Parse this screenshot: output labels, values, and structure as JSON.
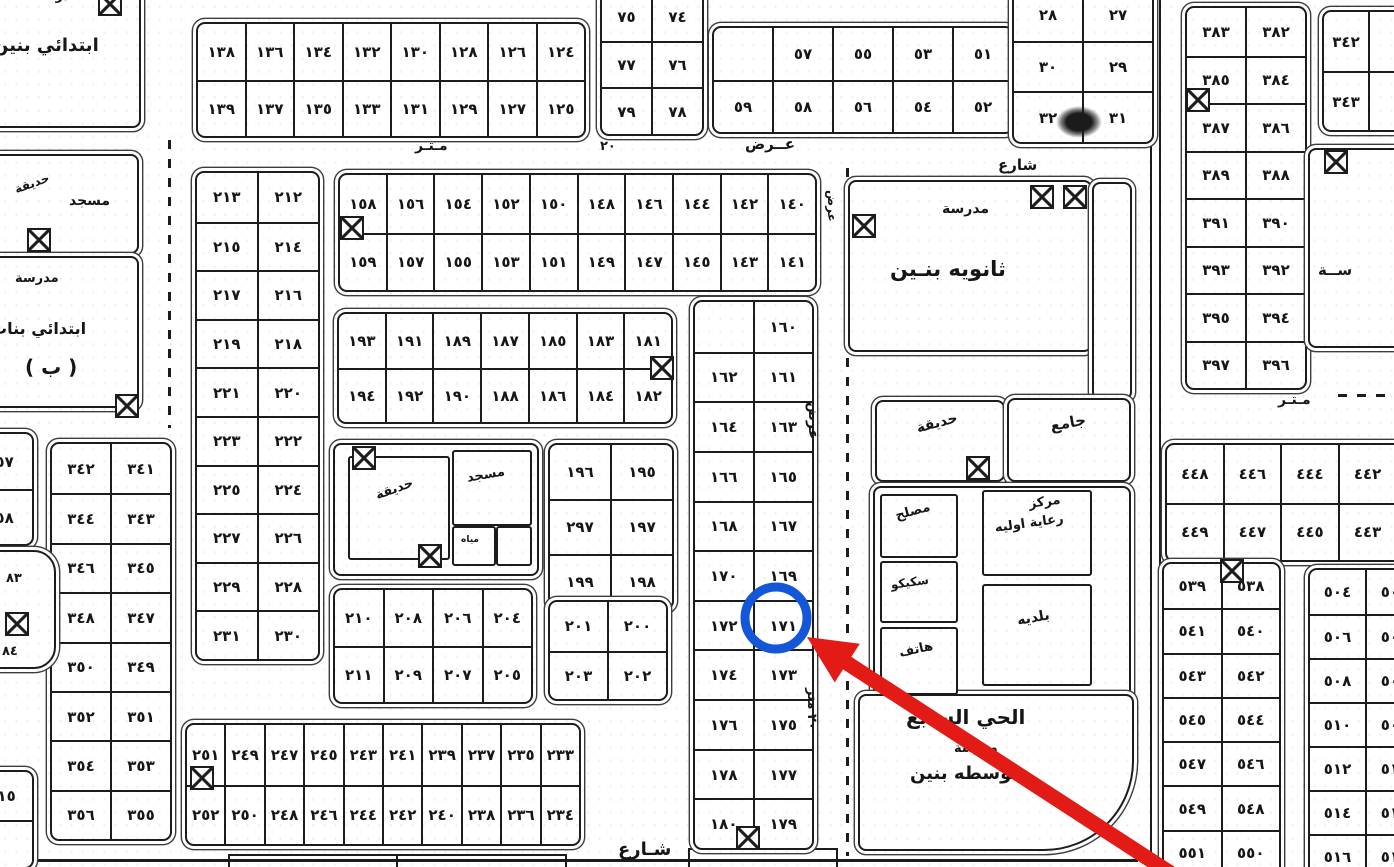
{
  "annotation": {
    "target_plot": "١٧١",
    "circle": {
      "cx": 776,
      "cy": 618,
      "r": 31,
      "stroke": "#1456d8",
      "width": 9
    },
    "arrow": {
      "color": "#e31b17",
      "tip_x": 807,
      "tip_y": 637,
      "tail_x": 1172,
      "tail_y": 874,
      "head_len": 48,
      "head_halfw": 23,
      "shaft_w": 15
    }
  },
  "street_labels": [
    {
      "t": "مـتـر",
      "x": 415,
      "y": 139,
      "s": 14,
      "r": 0
    },
    {
      "t": "٢٠",
      "x": 600,
      "y": 140,
      "s": 13,
      "r": 0
    },
    {
      "t": "عــرض",
      "x": 745,
      "y": 136,
      "s": 15,
      "r": 0
    },
    {
      "t": "شارع",
      "x": 998,
      "y": 157,
      "s": 15,
      "r": 0
    },
    {
      "t": "مـتـر",
      "x": 1278,
      "y": 393,
      "s": 14,
      "r": 0
    },
    {
      "t": "عرض",
      "x": 820,
      "y": 402,
      "s": 14,
      "r": 90
    },
    {
      "t": "٢٠ متر",
      "x": 818,
      "y": 688,
      "s": 13,
      "r": 90
    },
    {
      "t": "عرض",
      "x": 838,
      "y": 190,
      "s": 12,
      "r": 90
    },
    {
      "t": "شـارع",
      "x": 618,
      "y": 840,
      "s": 18,
      "r": 0
    },
    {
      "t": "٨٣",
      "x": 6,
      "y": 572,
      "s": 13,
      "r": 0
    },
    {
      "t": "٨٤",
      "x": 2,
      "y": 645,
      "s": 13,
      "r": 0
    }
  ],
  "plot_blocks": [
    {
      "name": "block-124-139",
      "x": 196,
      "y": 22,
      "w": 386,
      "h": 112,
      "rows": [
        [
          "١٣٨",
          "١٣٦",
          "١٣٤",
          "١٣٢",
          "١٣٠",
          "١٢٨",
          "١٢٦",
          "١٢٤"
        ],
        [
          "١٣٩",
          "١٣٧",
          "١٣٥",
          "١٣٣",
          "١٣١",
          "١٢٩",
          "١٢٧",
          "١٢٥"
        ]
      ]
    },
    {
      "name": "block-74-79",
      "x": 600,
      "y": -8,
      "w": 100,
      "h": 140,
      "rows": [
        [
          "٧٥",
          "٧٤"
        ],
        [
          "٧٧",
          "٧٦"
        ],
        [
          "٧٩",
          "٧٨"
        ]
      ]
    },
    {
      "name": "block-51-59",
      "x": 712,
      "y": 26,
      "w": 298,
      "h": 104,
      "rows": [
        [
          null,
          "٥٧",
          "٥٥",
          "٥٣",
          "٥١"
        ],
        [
          "٥٩",
          "٥٨",
          "٥٦",
          "٥٤",
          "٥٢"
        ]
      ]
    },
    {
      "name": "block-27-32",
      "x": 1012,
      "y": -12,
      "w": 138,
      "h": 152,
      "rows": [
        [
          "٢٨",
          "٢٧"
        ],
        [
          "٣٠",
          "٢٩"
        ],
        [
          "٣٢",
          "٣١"
        ]
      ]
    },
    {
      "name": "block-382-397",
      "x": 1185,
      "y": 6,
      "w": 118,
      "h": 380,
      "rows": [
        [
          "٣٨٣",
          "٣٨٢"
        ],
        [
          "٣٨٥",
          "٣٨٤"
        ],
        [
          "٣٨٧",
          "٣٨٦"
        ],
        [
          "٣٨٩",
          "٣٨٨"
        ],
        [
          "٣٩١",
          "٣٩٠"
        ],
        [
          "٣٩٣",
          "٣٩٢"
        ],
        [
          "٣٩٥",
          "٣٩٤"
        ],
        [
          "٣٩٧",
          "٣٩٦"
        ]
      ]
    },
    {
      "name": "block-342-343",
      "x": 1322,
      "y": 10,
      "w": 90,
      "h": 118,
      "rows": [
        [
          "٣٤٢",
          ""
        ],
        [
          "٣٤٣",
          ""
        ]
      ]
    },
    {
      "name": "block-440-449",
      "x": 1165,
      "y": 443,
      "w": 286,
      "h": 115,
      "rows": [
        [
          "٤٤٨",
          "٤٤٦",
          "٤٤٤",
          "٤٤٢",
          "٤٤٠"
        ],
        [
          "٤٤٩",
          "٤٤٧",
          "٤٤٥",
          "٤٤٣",
          "٤٤١"
        ]
      ]
    },
    {
      "name": "block-538-551",
      "x": 1162,
      "y": 562,
      "w": 115,
      "h": 310,
      "rows": [
        [
          "٥٣٩",
          "٥٣٨"
        ],
        [
          "٥٤١",
          "٥٤٠"
        ],
        [
          "٥٤٣",
          "٥٤٢"
        ],
        [
          "٥٤٥",
          "٥٤٤"
        ],
        [
          "٥٤٧",
          "٥٤٦"
        ],
        [
          "٥٤٩",
          "٥٤٨"
        ],
        [
          "٥٥١",
          "٥٥٠"
        ]
      ]
    },
    {
      "name": "block-503-516",
      "x": 1308,
      "y": 568,
      "w": 112,
      "h": 308,
      "rows": [
        [
          "٥٠٤",
          "٥٠٣"
        ],
        [
          "٥٠٦",
          "٥٠٥"
        ],
        [
          "٥٠٨",
          "٥٠٧"
        ],
        [
          "٥١٠",
          "٥٠٩"
        ],
        [
          "٥١٢",
          "٥١١"
        ],
        [
          "٥١٤",
          "٥١٣"
        ],
        [
          "٥١٦",
          "٥١٥"
        ]
      ]
    },
    {
      "name": "block-341-356",
      "x": 50,
      "y": 442,
      "w": 118,
      "h": 395,
      "rows": [
        [
          "٣٤٢",
          "٣٤١"
        ],
        [
          "٣٤٤",
          "٣٤٣"
        ],
        [
          "٣٤٦",
          "٣٤٥"
        ],
        [
          "٣٤٨",
          "٣٤٧"
        ],
        [
          "٣٥٠",
          "٣٤٩"
        ],
        [
          "٣٥٢",
          "٣٥١"
        ],
        [
          "٣٥٤",
          "٣٥٣"
        ],
        [
          "٣٥٦",
          "٣٥٥"
        ]
      ]
    },
    {
      "name": "block-212-231",
      "x": 195,
      "y": 171,
      "w": 121,
      "h": 486,
      "rows": [
        [
          "٢١٣",
          "٢١٢"
        ],
        [
          "٢١٥",
          "٢١٤"
        ],
        [
          "٢١٧",
          "٢١٦"
        ],
        [
          "٢١٩",
          "٢١٨"
        ],
        [
          "٢٢١",
          "٢٢٠"
        ],
        [
          "٢٢٣",
          "٢٢٢"
        ],
        [
          "٢٢٥",
          "٢٢٤"
        ],
        [
          "٢٢٧",
          "٢٢٦"
        ],
        [
          "٢٢٩",
          "٢٢٨"
        ],
        [
          "٢٣١",
          "٢٣٠"
        ]
      ]
    },
    {
      "name": "block-140-159",
      "x": 338,
      "y": 173,
      "w": 475,
      "h": 115,
      "rows": [
        [
          "١٥٨",
          "١٥٦",
          "١٥٤",
          "١٥٢",
          "١٥٠",
          "١٤٨",
          "١٤٦",
          "١٤٤",
          "١٤٢",
          "١٤٠"
        ],
        [
          "١٥٩",
          "١٥٧",
          "١٥٥",
          "١٥٣",
          "١٥١",
          "١٤٩",
          "١٤٧",
          "١٤٥",
          "١٤٣",
          "١٤١"
        ]
      ]
    },
    {
      "name": "block-181-194",
      "x": 337,
      "y": 312,
      "w": 332,
      "h": 108,
      "rows": [
        [
          "١٩٣",
          "١٩١",
          "١٨٩",
          "١٨٧",
          "١٨٥",
          "١٨٣",
          "١٨١"
        ],
        [
          "١٩٤",
          "١٩٢",
          "١٩٠",
          "١٨٨",
          "١٨٦",
          "١٨٤",
          "١٨٢"
        ]
      ]
    },
    {
      "name": "block-195-199",
      "x": 548,
      "y": 443,
      "w": 122,
      "h": 163,
      "rows": [
        [
          "١٩٦",
          "١٩٥"
        ],
        [
          "٢٩٧",
          "١٩٧"
        ],
        [
          "١٩٩",
          "١٩٨"
        ]
      ]
    },
    {
      "name": "block-200-203",
      "x": 548,
      "y": 600,
      "w": 116,
      "h": 97,
      "rows": [
        [
          "٢٠١",
          "٢٠٠"
        ],
        [
          "٢٠٣",
          "٢٠٢"
        ]
      ]
    },
    {
      "name": "block-204-211",
      "x": 333,
      "y": 588,
      "w": 196,
      "h": 112,
      "rows": [
        [
          "٢١٠",
          "٢٠٨",
          "٢٠٦",
          "٢٠٤"
        ],
        [
          "٢١١",
          "٢٠٩",
          "٢٠٧",
          "٢٠٥"
        ]
      ]
    },
    {
      "name": "block-160-180",
      "x": 693,
      "y": 300,
      "w": 117,
      "h": 546,
      "rows": [
        [
          null,
          "١٦٠"
        ],
        [
          "١٦٢",
          "١٦١"
        ],
        [
          "١٦٤",
          "١٦٣"
        ],
        [
          "١٦٦",
          "١٦٥"
        ],
        [
          "١٦٨",
          "١٦٧"
        ],
        [
          "١٧٠",
          "١٦٩"
        ],
        [
          "١٧٢",
          "١٧١"
        ],
        [
          "١٧٤",
          "١٧٣"
        ],
        [
          "١٧٦",
          "١٧٥"
        ],
        [
          "١٧٨",
          "١٧٧"
        ],
        [
          "١٨٠",
          "١٧٩"
        ]
      ]
    },
    {
      "name": "block-233-252",
      "x": 185,
      "y": 723,
      "w": 392,
      "h": 119,
      "rows": [
        [
          "٢٥١",
          "٢٤٩",
          "٢٤٧",
          "٢٤٥",
          "٢٤٣",
          "٢٤١",
          "٢٣٩",
          "٢٣٧",
          "٢٣٥",
          "٢٣٣"
        ],
        [
          "٢٥٢",
          "٢٥٠",
          "٢٤٨",
          "٢٤٦",
          "٢٤٤",
          "٢٤٢",
          "٢٤٠",
          "٢٣٨",
          "٢٣٦",
          "٢٣٤"
        ]
      ]
    },
    {
      "name": "block-357-358",
      "x": -34,
      "y": 432,
      "w": 64,
      "h": 110,
      "rows": [
        [
          "٣٥٧"
        ],
        [
          "٣٥٨"
        ]
      ]
    },
    {
      "name": "block-515",
      "x": -30,
      "y": 770,
      "w": 60,
      "h": 95,
      "rows": [
        [
          "٥١٥"
        ],
        [
          ""
        ]
      ]
    }
  ],
  "buildings": [
    {
      "name": "school-boys-primary",
      "x": -15,
      "y": -10,
      "w": 152,
      "h": 134,
      "labels": [
        {
          "t": "مدرسة",
          "x": 48,
          "y": -2,
          "s": 13,
          "r": 0
        },
        {
          "t": "ابتدائي بنين",
          "x": 6,
          "y": 44,
          "s": 18,
          "r": 0
        }
      ]
    },
    {
      "name": "mosque-garden-west",
      "x": -15,
      "y": 154,
      "w": 150,
      "h": 96,
      "labels": [
        {
          "t": "حديقة",
          "x": 26,
          "y": 28,
          "s": 12,
          "r": -20
        },
        {
          "t": "مسجد",
          "x": 82,
          "y": 38,
          "s": 14,
          "r": 0
        }
      ]
    },
    {
      "name": "school-girls-primary",
      "x": -15,
      "y": 256,
      "w": 150,
      "h": 148,
      "labels": [
        {
          "t": "مدرسة",
          "x": 28,
          "y": 14,
          "s": 13,
          "r": 0
        },
        {
          "t": "ابتدائي بنات",
          "x": 4,
          "y": 62,
          "s": 16,
          "r": 0
        },
        {
          "t": "( ب )",
          "x": 38,
          "y": 98,
          "s": 20,
          "r": 0
        }
      ]
    },
    {
      "name": "school-secondary-boys",
      "x": 848,
      "y": 180,
      "w": 240,
      "h": 168,
      "labels": [
        {
          "t": "مدرسة",
          "x": 92,
          "y": 20,
          "s": 14,
          "r": 0
        },
        {
          "t": "ثانويه بنـين",
          "x": 40,
          "y": 76,
          "s": 21,
          "r": 0
        }
      ]
    },
    {
      "name": "school-corridor",
      "x": 1092,
      "y": 182,
      "w": 36,
      "h": 214,
      "labels": []
    },
    {
      "name": "right-edge-building",
      "x": 1308,
      "y": 148,
      "w": 100,
      "h": 196,
      "labels": [
        {
          "t": "ســة",
          "x": 8,
          "y": 112,
          "s": 15,
          "r": 0
        }
      ]
    },
    {
      "name": "garden-park",
      "x": 875,
      "y": 400,
      "w": 126,
      "h": 78,
      "labels": [
        {
          "t": "حديقة",
          "x": 38,
          "y": 20,
          "s": 14,
          "r": -15
        }
      ]
    },
    {
      "name": "jami-mosque",
      "x": 1007,
      "y": 398,
      "w": 120,
      "h": 80,
      "labels": [
        {
          "t": "جامع",
          "x": 40,
          "y": 18,
          "s": 15,
          "r": -10
        }
      ]
    },
    {
      "name": "services-compound",
      "x": 873,
      "y": 486,
      "w": 254,
      "h": 229,
      "labels": []
    },
    {
      "name": "maslah-office",
      "x": 880,
      "y": 494,
      "w": 74,
      "h": 60,
      "inner": true,
      "labels": [
        {
          "t": "مصلح",
          "x": 12,
          "y": 14,
          "s": 13,
          "r": -15
        }
      ]
    },
    {
      "name": "sceco-electric",
      "x": 880,
      "y": 561,
      "w": 74,
      "h": 58,
      "inner": true,
      "labels": [
        {
          "t": "سكيكو",
          "x": 8,
          "y": 16,
          "s": 12,
          "r": -8
        }
      ]
    },
    {
      "name": "telephone-office",
      "x": 880,
      "y": 627,
      "w": 74,
      "h": 64,
      "inner": true,
      "labels": [
        {
          "t": "هاتف",
          "x": 16,
          "y": 18,
          "s": 13,
          "r": -12
        }
      ]
    },
    {
      "name": "primary-care-center",
      "x": 982,
      "y": 490,
      "w": 106,
      "h": 82,
      "inner": true,
      "labels": [
        {
          "t": "مركز",
          "x": 44,
          "y": 6,
          "s": 13,
          "r": -8
        },
        {
          "t": "رعاية اوليه",
          "x": 10,
          "y": 30,
          "s": 13,
          "r": -8
        }
      ]
    },
    {
      "name": "municipality",
      "x": 982,
      "y": 584,
      "w": 106,
      "h": 98,
      "inner": true,
      "labels": [
        {
          "t": "بلديه",
          "x": 32,
          "y": 28,
          "s": 14,
          "r": -10
        }
      ]
    },
    {
      "name": "district-middle-school",
      "x": 858,
      "y": 694,
      "w": 272,
      "h": 153,
      "radius": "8px 8px 90px 8px",
      "labels": [
        {
          "t": "الحي السابع",
          "x": 46,
          "y": 10,
          "s": 20,
          "r": 0
        },
        {
          "t": "مدرسة",
          "x": 94,
          "y": 46,
          "s": 13,
          "r": 0
        },
        {
          "t": "متوسطه بنين",
          "x": 50,
          "y": 68,
          "s": 18,
          "r": 0
        }
      ]
    },
    {
      "name": "mosque-complex",
      "x": 333,
      "y": 443,
      "w": 202,
      "h": 129,
      "labels": []
    },
    {
      "name": "complex-garden",
      "x": 348,
      "y": 456,
      "w": 98,
      "h": 100,
      "inner": true,
      "labels": [
        {
          "t": "حديقة",
          "x": 24,
          "y": 32,
          "s": 13,
          "r": -20
        }
      ]
    },
    {
      "name": "complex-mosque",
      "x": 452,
      "y": 450,
      "w": 76,
      "h": 72,
      "inner": true,
      "labels": [
        {
          "t": "مسجد",
          "x": 12,
          "y": 20,
          "s": 13,
          "r": -10
        }
      ]
    },
    {
      "name": "complex-water-room",
      "x": 452,
      "y": 526,
      "w": 40,
      "h": 36,
      "inner": true,
      "labels": [
        {
          "t": "مياه",
          "x": 7,
          "y": 8,
          "s": 9,
          "r": 0
        }
      ]
    },
    {
      "name": "complex-small-room",
      "x": 496,
      "y": 526,
      "w": 32,
      "h": 36,
      "inner": true,
      "labels": []
    },
    {
      "name": "octagon-lot",
      "x": -28,
      "y": 550,
      "w": 80,
      "h": 115,
      "radius": "22px",
      "labels": []
    }
  ],
  "xbox_icons": [
    {
      "x": 98,
      "y": -8
    },
    {
      "x": 27,
      "y": 228
    },
    {
      "x": 115,
      "y": 394
    },
    {
      "x": 340,
      "y": 216
    },
    {
      "x": 650,
      "y": 356
    },
    {
      "x": 352,
      "y": 446
    },
    {
      "x": 418,
      "y": 544
    },
    {
      "x": 852,
      "y": 214
    },
    {
      "x": 1030,
      "y": 185
    },
    {
      "x": 1063,
      "y": 185
    },
    {
      "x": 966,
      "y": 456
    },
    {
      "x": 1186,
      "y": 88
    },
    {
      "x": 1324,
      "y": 150
    },
    {
      "x": 1220,
      "y": 559
    },
    {
      "x": 190,
      "y": 766
    },
    {
      "x": 736,
      "y": 826
    },
    {
      "x": 5,
      "y": 612
    }
  ],
  "lines": [
    {
      "x": 846,
      "y": 168,
      "len": 688,
      "o": "v",
      "dash": true
    },
    {
      "x": 168,
      "y": 140,
      "len": 288,
      "o": "v",
      "dash": true
    },
    {
      "x": 1338,
      "y": 394,
      "len": 58,
      "o": "h",
      "dash": true
    },
    {
      "x": 1150,
      "y": 0,
      "len": 862,
      "o": "v",
      "dash": false
    },
    {
      "x": 1159,
      "y": 0,
      "len": 862,
      "o": "v",
      "dash": false
    },
    {
      "x": 60,
      "y": 158,
      "len": 90,
      "o": "v",
      "dash": false
    },
    {
      "x": 0,
      "y": 859,
      "len": 1138,
      "o": "h",
      "dash": false,
      "w": 3
    },
    {
      "x": 228,
      "y": 854,
      "len": 338,
      "o": "h",
      "dash": false
    },
    {
      "x": 228,
      "y": 854,
      "len": 13,
      "o": "v",
      "dash": false
    },
    {
      "x": 396,
      "y": 854,
      "len": 13,
      "o": "v",
      "dash": false
    },
    {
      "x": 565,
      "y": 854,
      "len": 13,
      "o": "v",
      "dash": false
    },
    {
      "x": 688,
      "y": 848,
      "len": 150,
      "o": "h",
      "dash": false
    },
    {
      "x": 688,
      "y": 848,
      "len": 19,
      "o": "v",
      "dash": false
    },
    {
      "x": 836,
      "y": 848,
      "len": 19,
      "o": "v",
      "dash": false
    }
  ],
  "stains": [
    {
      "x": 1056,
      "y": 106,
      "w": 46,
      "h": 32
    }
  ],
  "colors": {
    "ink": "#1c1c1c",
    "paper": "#ffffff",
    "highlight_blue": "#1456d8",
    "arrow_red": "#e31b17"
  }
}
